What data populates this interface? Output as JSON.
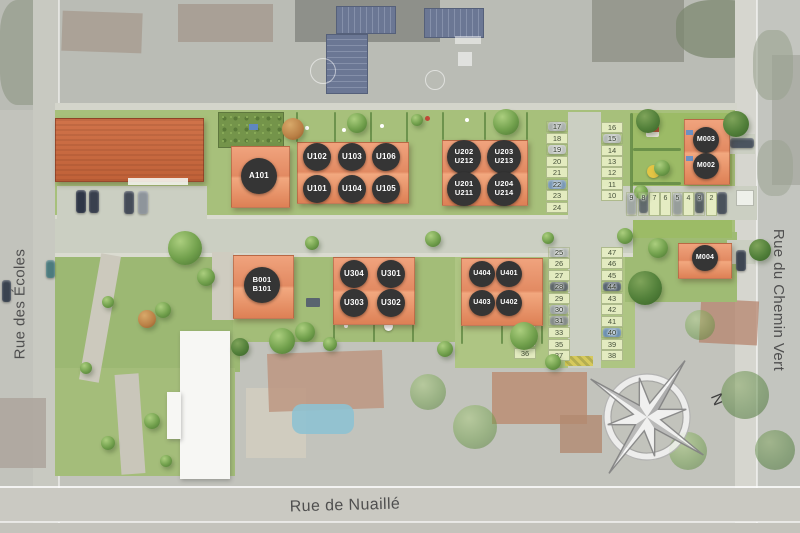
{
  "plan": {
    "streets": {
      "left": "Rue des Écoles",
      "right": "Rue du Chemin Vert",
      "bottom": "Rue de Nuaillé"
    },
    "compass": {
      "north": "N"
    },
    "units": {
      "a101": {
        "label": "A101"
      },
      "u102": {
        "label": "U102"
      },
      "u103": {
        "label": "U103"
      },
      "u106": {
        "label": "U106"
      },
      "u101": {
        "label": "U101"
      },
      "u104": {
        "label": "U104"
      },
      "u105": {
        "label": "U105"
      },
      "u202": {
        "line1": "U202",
        "line2": "U212"
      },
      "u203": {
        "line1": "U203",
        "line2": "U213"
      },
      "u201": {
        "line1": "U201",
        "line2": "U211"
      },
      "u204": {
        "line1": "U204",
        "line2": "U214"
      },
      "m003": {
        "label": "M003"
      },
      "m002": {
        "label": "M002"
      },
      "m004": {
        "label": "M004"
      },
      "b001": {
        "line1": "B001",
        "line2": "B101"
      },
      "u304": {
        "label": "U304"
      },
      "u301": {
        "label": "U301"
      },
      "u303": {
        "label": "U303"
      },
      "u302": {
        "label": "U302"
      },
      "u404": {
        "label": "U404"
      },
      "u401": {
        "label": "U401"
      },
      "u403": {
        "label": "U403"
      },
      "u402": {
        "label": "U402"
      }
    },
    "parking": {
      "col_a": [
        "17",
        "18",
        "19",
        "20",
        "21",
        "22",
        "23",
        "24"
      ],
      "col_b": [
        "16",
        "15",
        "14",
        "13",
        "12",
        "11",
        "10"
      ],
      "row_north": [
        "9",
        "8",
        "7",
        "6",
        "5",
        "4",
        "3",
        "2"
      ],
      "col_c_inner": [
        "25",
        "26",
        "27",
        "28",
        "29",
        "30",
        "31",
        "33",
        "35",
        "37"
      ],
      "col_c_outer": [
        "48",
        "49",
        "32",
        "34",
        "36"
      ],
      "col_d": [
        "47",
        "46",
        "45",
        "44",
        "43",
        "42",
        "41",
        "40",
        "39",
        "38"
      ]
    },
    "colors": {
      "new_roof": "#e8956f",
      "existing_roof": "#c97046",
      "unit_badge": "#353535",
      "grass": "#a6c17c",
      "road": "#cbcfc2",
      "stall": "#e6edc3"
    }
  }
}
